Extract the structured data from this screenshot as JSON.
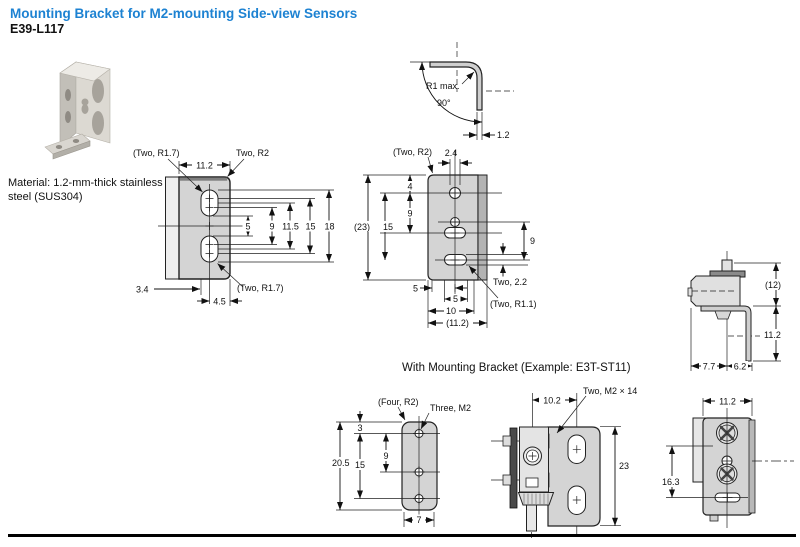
{
  "page": {
    "title": "Mounting Bracket for M2-mounting Side-view Sensors",
    "model": "E39-L117",
    "material_lines": [
      "Material: 1.2-mm-thick stainless",
      "steel (SUS304)"
    ],
    "section_heading": "With Mounting Bracket (Example: E3T-ST11)",
    "accent_color": "#1d82d2"
  },
  "drawings": {
    "side_view": {
      "label_top_radius": "(Two, R1.7)",
      "width": "11.2",
      "label_corner_radius": "Two, R2",
      "dim_5": "5",
      "dim_9": "9",
      "dim_11_5": "11.5",
      "dim_15": "15",
      "dim_18": "18",
      "dim_3_4": "3.4",
      "dim_4_5": "4.5",
      "label_bottom_radius": "(Two, R1.7)"
    },
    "bend_section": {
      "radius": "R1 max.",
      "angle": "90°",
      "thickness": "1.2"
    },
    "front_view": {
      "label_corner_radius": "(Two, R2)",
      "dim_2_4": "2.4",
      "dim_4": "4",
      "dim_9_left": "9",
      "dim_23": "(23)",
      "dim_15": "15",
      "dim_9_right": "9",
      "label_slot_height": "Two, 2.2",
      "label_slot_radius": "(Two, R1.1)",
      "dim_5_offset": "5",
      "dim_5_slot": "5",
      "dim_10": "10",
      "dim_11_2": "(11.2)"
    },
    "mounted_side": {
      "dim_12": "(12)",
      "dim_11_2": "11.2",
      "dim_7_7": "7.7",
      "dim_6_2": "6.2"
    },
    "plate": {
      "label_corner_radius": "(Four, R2)",
      "label_holes": "Three, M2",
      "dim_3": "3",
      "dim_9": "9",
      "dim_20_5": "20.5",
      "dim_15": "15",
      "dim_7": "7"
    },
    "mounted_front": {
      "label_screws": "Two, M2 × 14",
      "dim_10_2": "10.2",
      "dim_23": "23"
    },
    "mounted_rear": {
      "dim_11_2": "11.2",
      "dim_16_3": "16.3"
    }
  }
}
